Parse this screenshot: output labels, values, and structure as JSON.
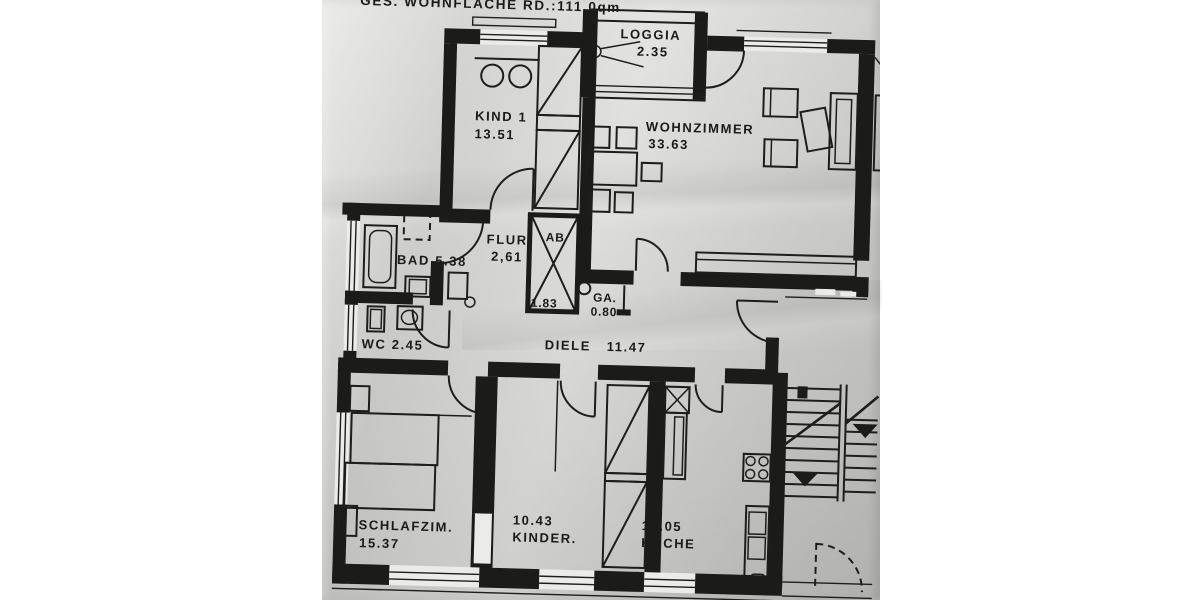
{
  "header": {
    "total_area_label": "GES. WOHNFLACHE RD.:111.0qm"
  },
  "rooms": {
    "loggia": {
      "name": "LOGGIA",
      "area": "2.35"
    },
    "kind1": {
      "name": "KIND 1",
      "area": "13.51"
    },
    "wohnzimmer": {
      "name": "WOHNZIMMER",
      "area": "33.63"
    },
    "bad": {
      "label": "BAD 5.38"
    },
    "flur": {
      "name": "FLUR",
      "area": "2,61"
    },
    "ab_shaft": {
      "name": "AB",
      "area": "1.83"
    },
    "ga": {
      "name": "GA.",
      "area": "0.80"
    },
    "wc": {
      "label": "WC 2.45"
    },
    "diele": {
      "name": "DIELE",
      "area": "11.47"
    },
    "schlafzimmer": {
      "name": "SCHLAFZIM.",
      "area": "15.37"
    },
    "kinderzimmer": {
      "area": "10.43",
      "name": "KINDER."
    },
    "kueche": {
      "area": "10.05",
      "name": "KUCHE"
    }
  },
  "colors": {
    "paper": "#d9d9d7",
    "ink": "#1b1b19",
    "margin": "#ffffff"
  }
}
